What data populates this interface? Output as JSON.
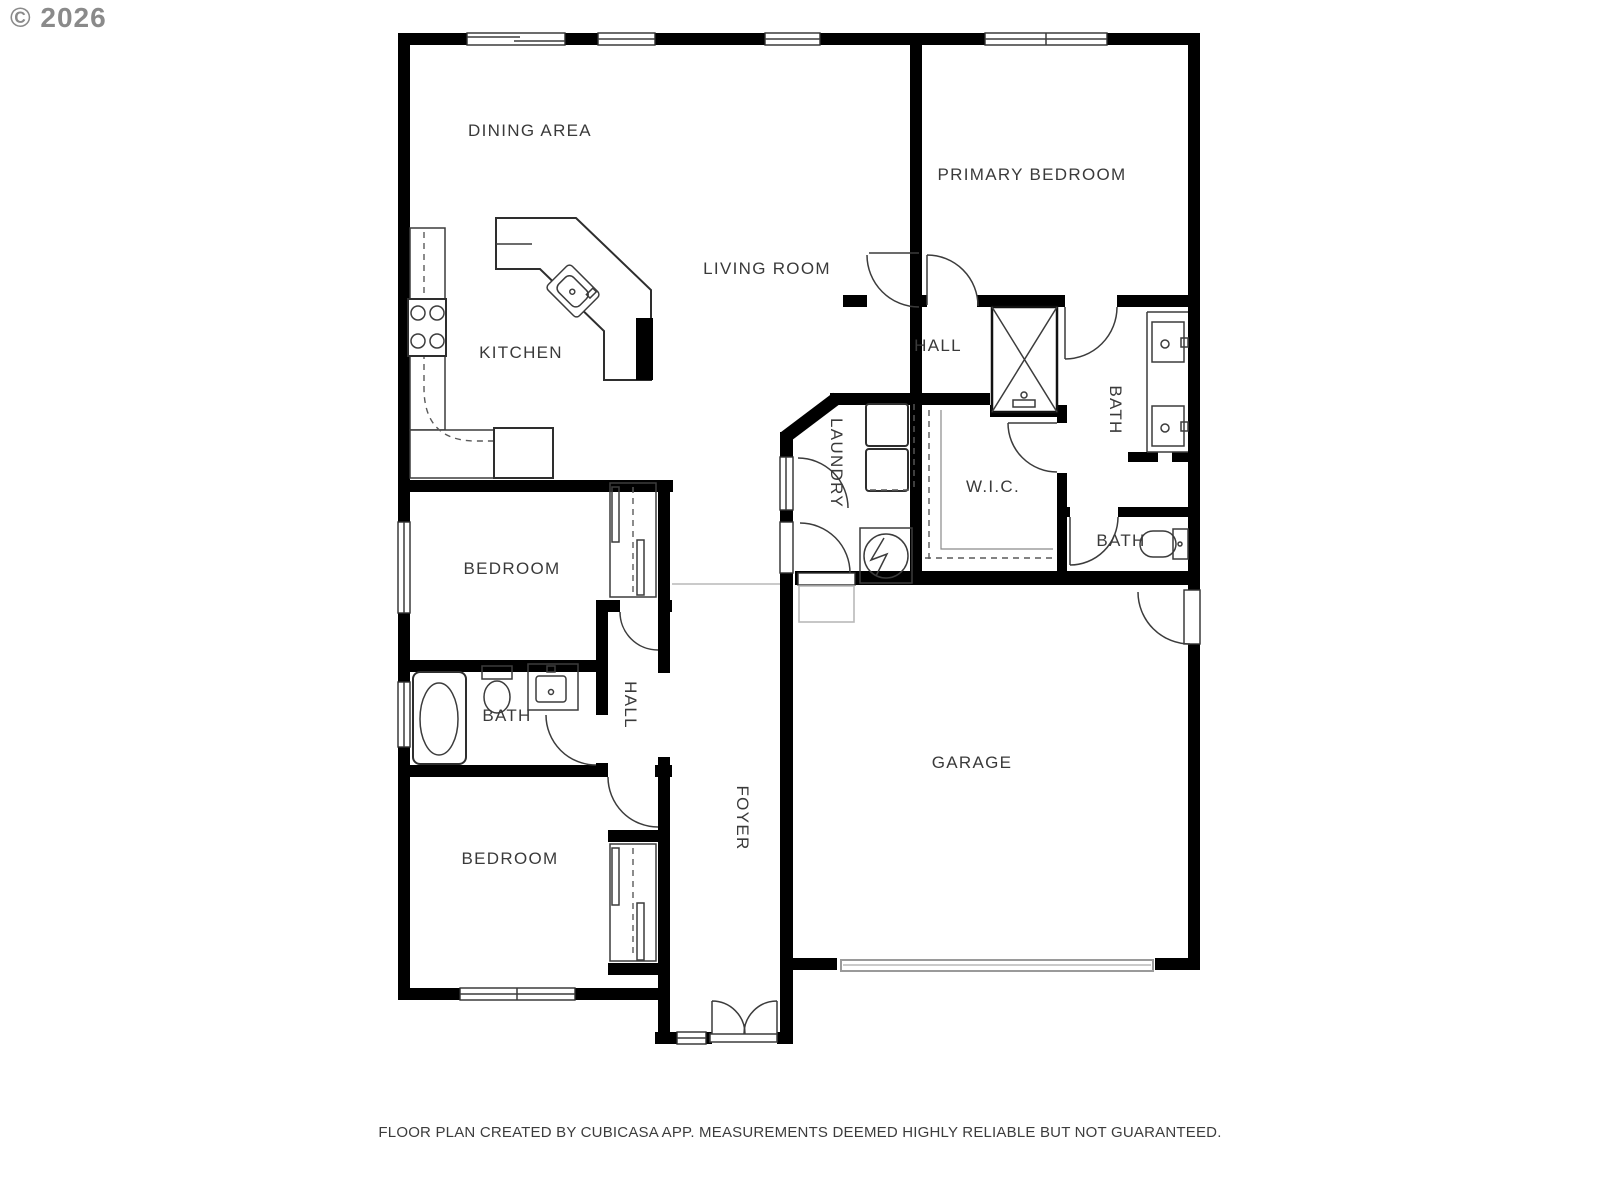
{
  "watermark": "© 2026",
  "footer": "FLOOR PLAN CREATED BY CUBICASA APP. MEASUREMENTS DEEMED HIGHLY RELIABLE BUT NOT GUARANTEED.",
  "rooms": {
    "dining": "DINING AREA",
    "kitchen": "KITCHEN",
    "living": "LIVING ROOM",
    "primary": "PRIMARY BEDROOM",
    "hall_upper": "HALL",
    "bath_primary": "BATH",
    "wic": "W.I.C.",
    "laundry": "LAUNDRY",
    "bath_small": "BATH",
    "bedroom_mid": "BEDROOM",
    "bath_left": "BATH",
    "hall_lower": "HALL",
    "bedroom_lower": "BEDROOM",
    "foyer": "FOYER",
    "garage": "GARAGE"
  },
  "colors": {
    "wall": "#000000",
    "fixture_line": "#3c3c3c",
    "label": "#3a3a3a",
    "watermark": "#8a8a8a",
    "garage_door": "#9a9a9a",
    "background": "#ffffff"
  }
}
